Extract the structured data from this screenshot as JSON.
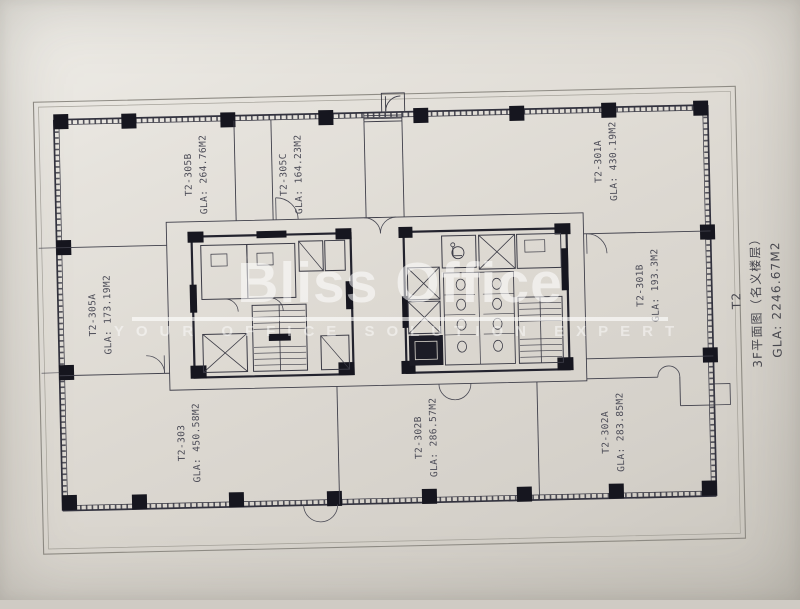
{
  "plan": {
    "units": [
      {
        "id": "T2-305B",
        "gla": "GLA: 264.76M2"
      },
      {
        "id": "T2-305C",
        "gla": "GLA: 164.23M2"
      },
      {
        "id": "T2-301A",
        "gla": "GLA: 430.19M2"
      },
      {
        "id": "T2-305A",
        "gla": "GLA: 173.19M2"
      },
      {
        "id": "T2-301B",
        "gla": "GLA: 193.3M2"
      },
      {
        "id": "T2-303",
        "gla": "GLA: 450.58M2"
      },
      {
        "id": "T2-302B",
        "gla": "GLA: 286.57M2"
      },
      {
        "id": "T2-302A",
        "gla": "GLA: 283.85M2"
      }
    ],
    "title_block": {
      "tower": "T2",
      "floor_label": "3F平面图（名义楼层）",
      "total_gla": "GLA: 2246.67M2"
    }
  },
  "watermark": {
    "brand": "Bliss Office",
    "tagline": "YOUR OFFICE SOLUTION EXPERT"
  },
  "colors": {
    "paper": "#dedad2",
    "ink": "#32323e",
    "column": "#16161f",
    "watermark_white": "#ffffff"
  }
}
